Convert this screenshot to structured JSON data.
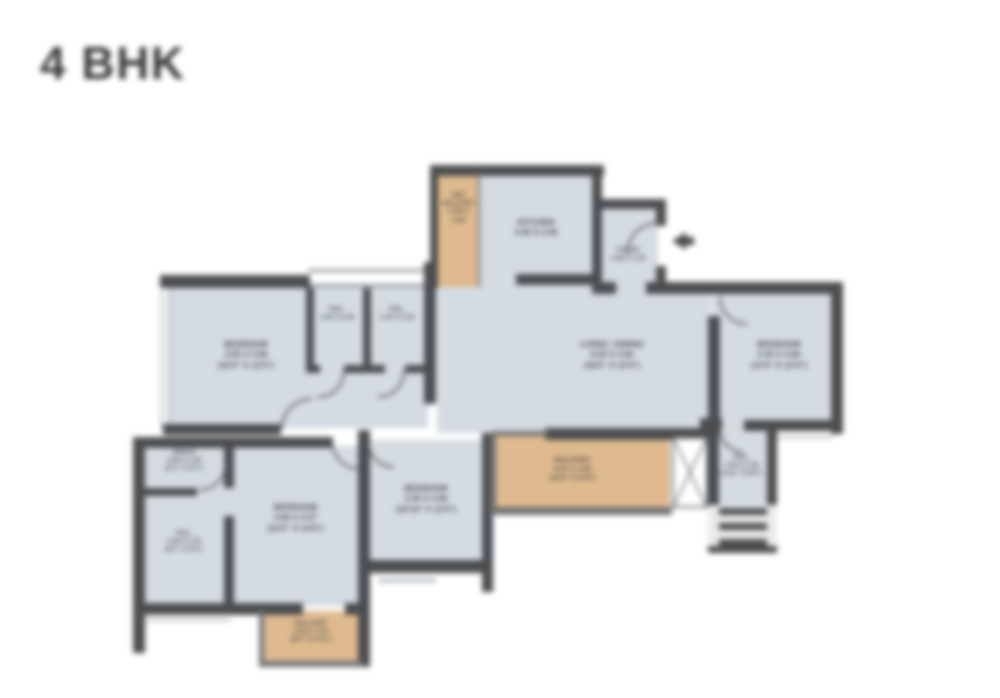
{
  "title": "4 BHK",
  "colors": {
    "wall": "#4b4d4f",
    "room_fill": "#d4dbe1",
    "balcony_fill": "#deba8e",
    "label_text": "#3c4144",
    "title_text": "#3a3c3e",
    "background": "#ffffff"
  },
  "plan": {
    "rooms": [
      {
        "id": "dry-balcony",
        "lines": [
          "DRY",
          "BALCONY",
          "0.95 X",
          "2.90"
        ]
      },
      {
        "id": "kitchen",
        "lines": [
          "KITCHEN",
          "3.05 X 2.90"
        ]
      },
      {
        "id": "foyer",
        "lines": [
          "FOYER",
          "1.85 X 1.20"
        ]
      },
      {
        "id": "bedroom-1",
        "lines": [
          "BEDROOM",
          "3.05 X 3.66",
          "(10'0\" X 12'0\")"
        ]
      },
      {
        "id": "toilet-1",
        "lines": [
          "TOIL.",
          "1.40 X 2.20"
        ]
      },
      {
        "id": "toilet-2",
        "lines": [
          "TOIL.",
          "1.40 X 2.20"
        ]
      },
      {
        "id": "living-dining",
        "lines": [
          "LIVING / DINING",
          "5.50 X 3.66",
          "(18'0\" X 12'0\")"
        ]
      },
      {
        "id": "bedroom-2",
        "lines": [
          "BEDROOM",
          "3.35 X 3.66",
          "(11'0\" X 12'0\")"
        ]
      },
      {
        "id": "dress",
        "lines": [
          "DRESS",
          "1.85 X 1.40",
          "(6'1\" X 4'7\")"
        ]
      },
      {
        "id": "toilet-3",
        "lines": [
          "TOIL.",
          "1.85 X 2.75",
          "(6'1\" X 9'0\")"
        ]
      },
      {
        "id": "bedroom-3",
        "lines": [
          "BEDROOM",
          "3.66 X 4.27",
          "(12'0\" X 14'0\")"
        ]
      },
      {
        "id": "bedroom-4",
        "lines": [
          "BEDROOM",
          "3.30 X 3.66",
          "(10'10\" X 12'0\")"
        ]
      },
      {
        "id": "balcony-1",
        "lines": [
          "BALCONY",
          "4.57 X 1.83",
          "(15'0\" X 6'0\")"
        ]
      },
      {
        "id": "toilet-4",
        "lines": [
          "TOIL.",
          "1.50 X 2.45",
          "(4'11\" X 8'0\")"
        ]
      },
      {
        "id": "balcony-2",
        "lines": [
          "BALCONY",
          "2.45 X 1.50",
          "(8'0\" X 4'11\")"
        ]
      }
    ],
    "entry_label": "ENTRY"
  }
}
